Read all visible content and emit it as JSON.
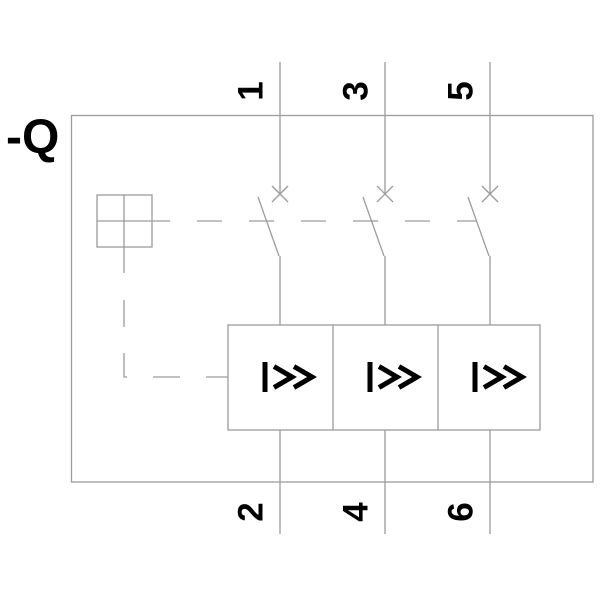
{
  "figure": {
    "device_label": "-Q",
    "poles": [
      {
        "top_terminal": "1",
        "bottom_terminal": "2",
        "trip_symbol": "I>>"
      },
      {
        "top_terminal": "3",
        "bottom_terminal": "4",
        "trip_symbol": "I>>"
      },
      {
        "top_terminal": "5",
        "bottom_terminal": "6",
        "trip_symbol": "I>>"
      }
    ],
    "colors": {
      "line_gray": "#9c9c9c",
      "symbol_black": "#000000",
      "background": "#ffffff"
    }
  }
}
